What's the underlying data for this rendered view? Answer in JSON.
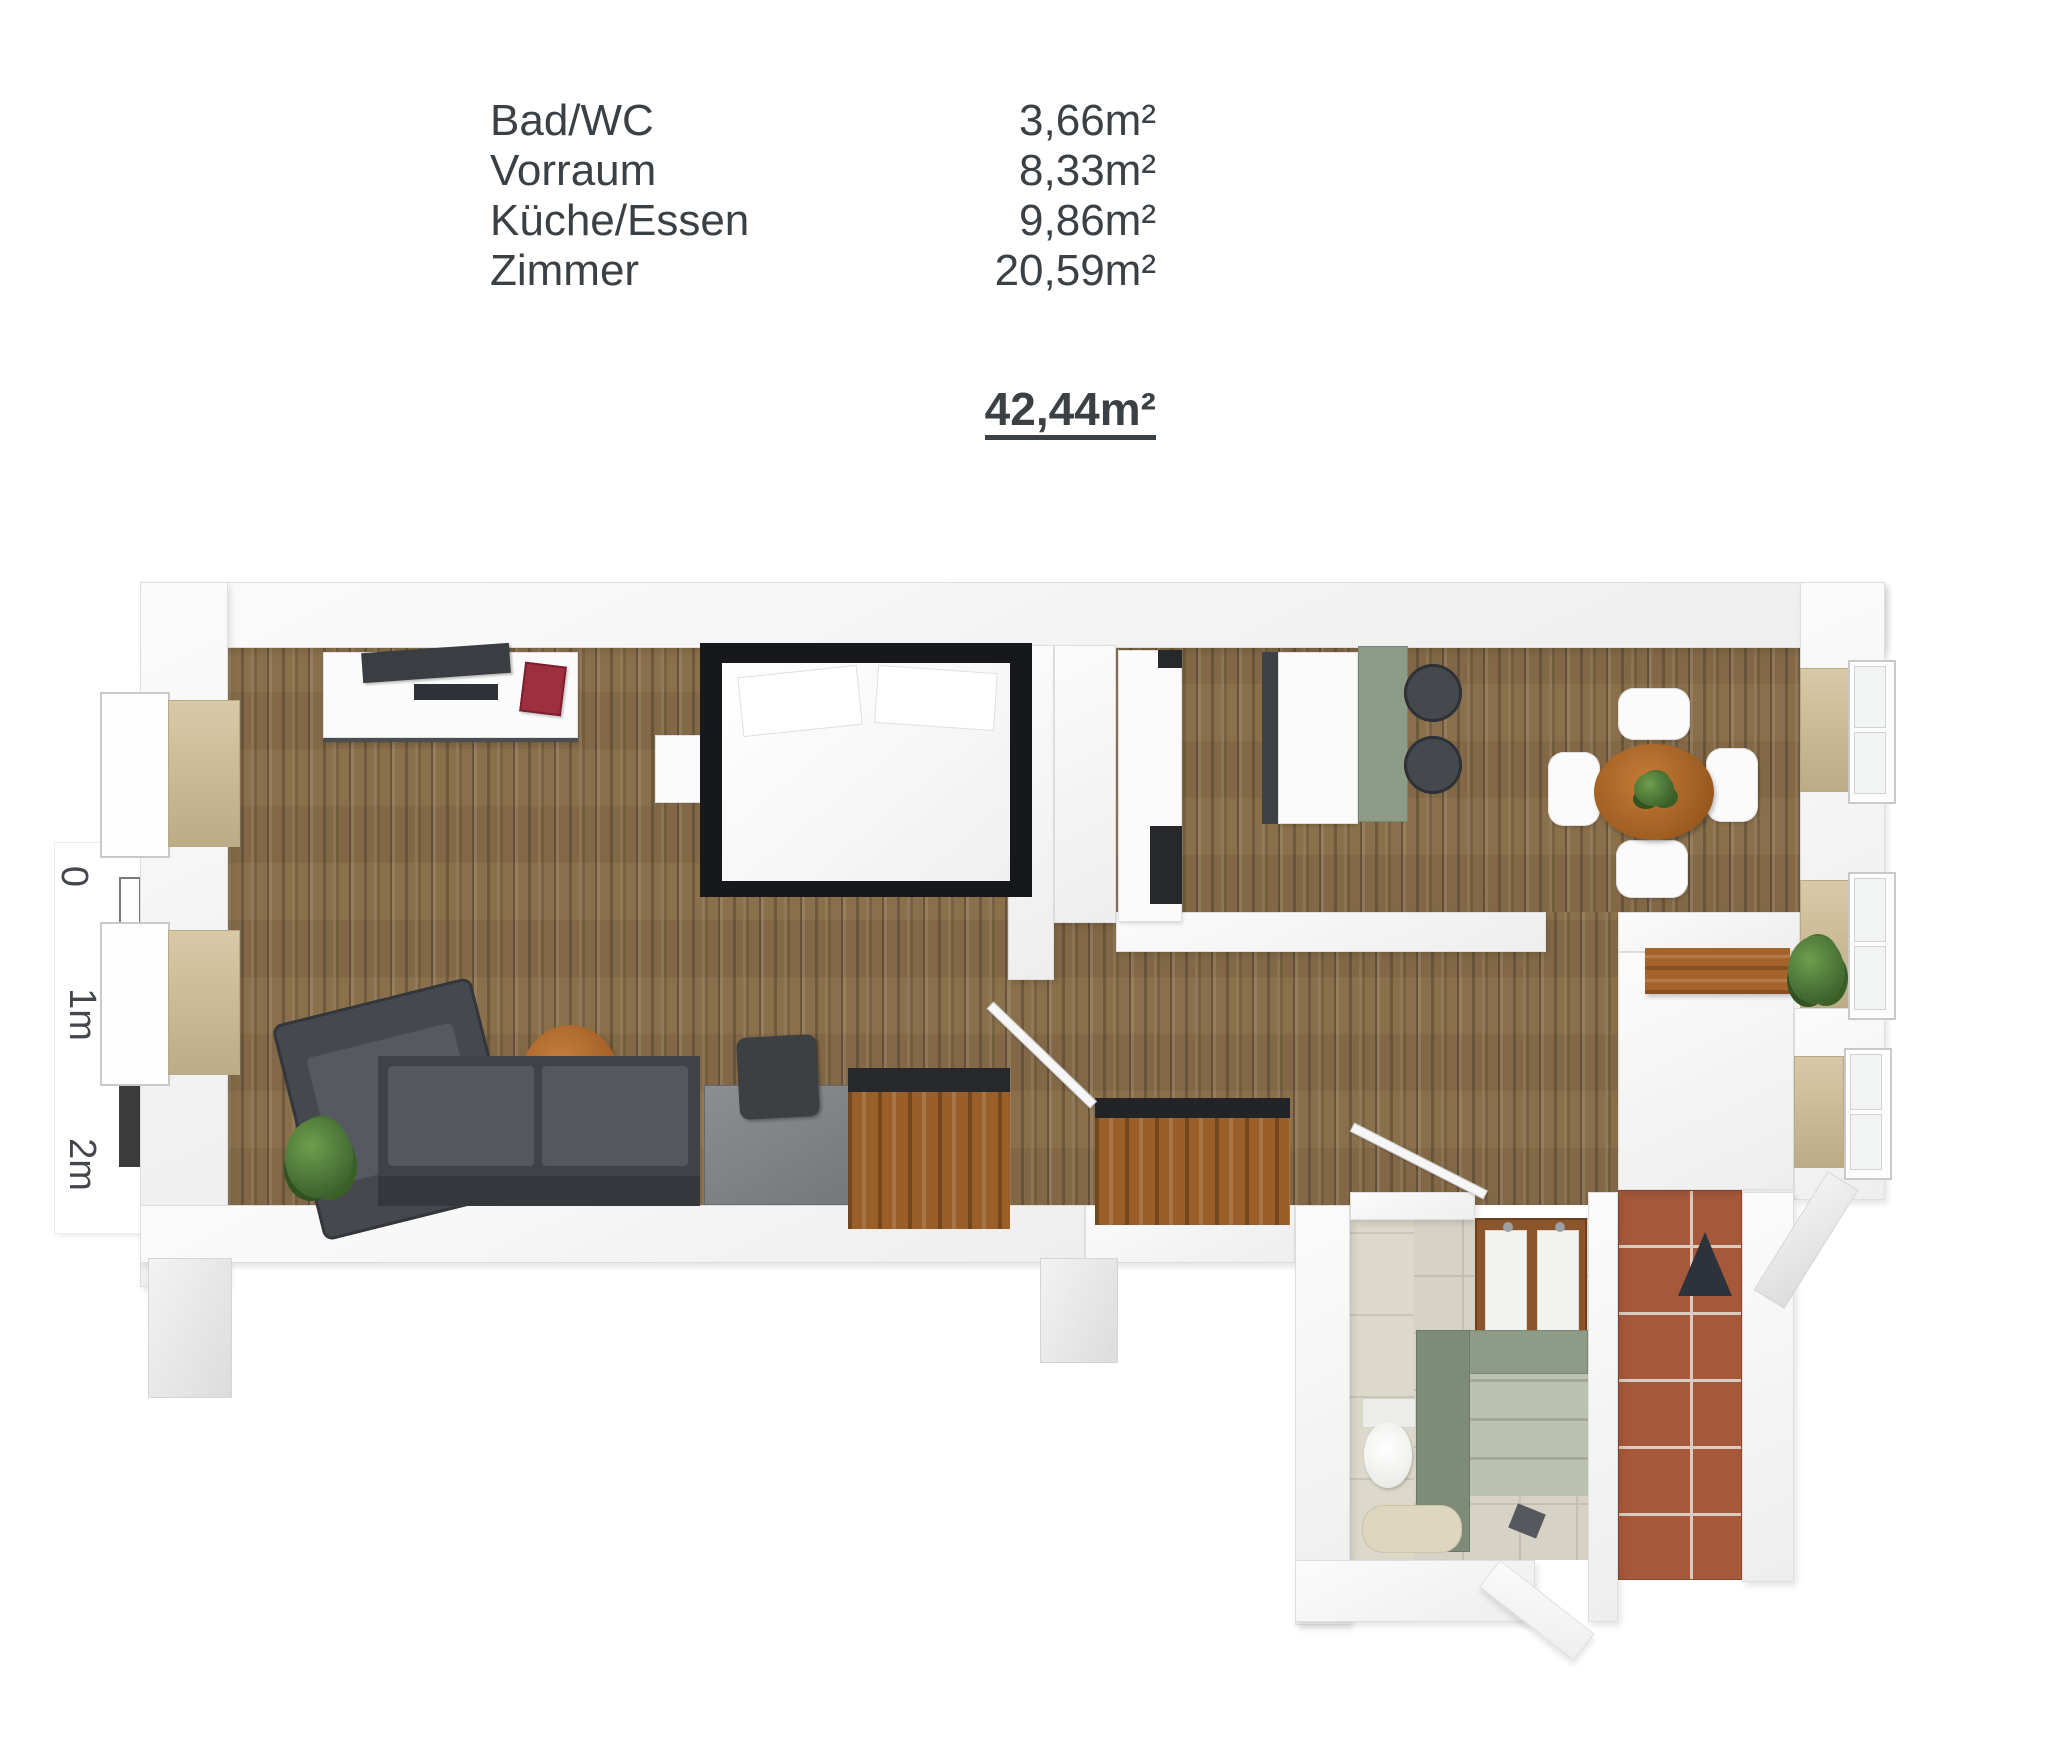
{
  "legend": {
    "rooms": [
      {
        "name": "Bad/WC",
        "area": "3,66m²"
      },
      {
        "name": "Vorraum",
        "area": "8,33m²"
      },
      {
        "name": "Küche/Essen",
        "area": "9,86m²"
      },
      {
        "name": "Zimmer",
        "area": "20,59m²"
      }
    ],
    "total": "42,44m²"
  },
  "scale_bar": {
    "labels": [
      "0",
      "1m",
      "2m"
    ]
  },
  "colors": {
    "text": "#3b4045",
    "wall": "#f7f7f7",
    "wood": "#8a6f4b",
    "cabinet_wood": "#9a5f28",
    "furniture_dark": "#45494e",
    "tv": "#3a3d42",
    "accent_red": "#9d2f3f",
    "sage": "#8e9b88",
    "tile": "#d6d2c6",
    "terracotta": "#a5583a",
    "grout": "#d8ccc0",
    "tan_sill": "#c9b897",
    "plant": "#4a7337"
  }
}
